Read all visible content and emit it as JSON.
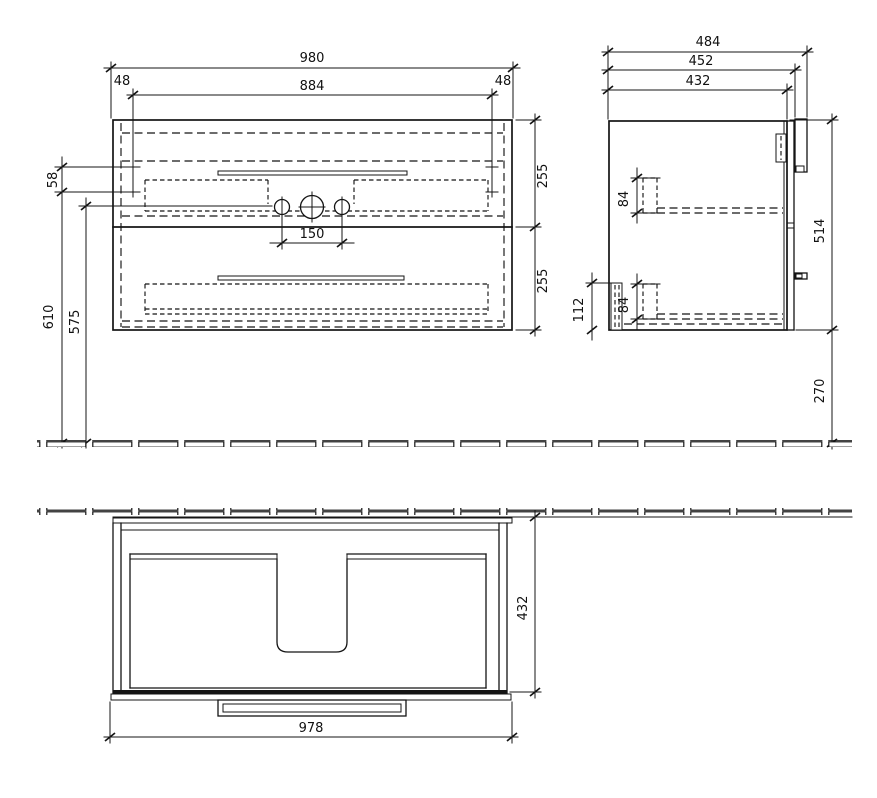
{
  "drawing": {
    "background": "#ffffff",
    "line_color": "#141414"
  },
  "dims": {
    "front": {
      "width_overall": "980",
      "width_inner": "884",
      "offset_left": "48",
      "offset_right": "48",
      "top_detail": "58",
      "height_total": "610",
      "height_holes": "575",
      "hole_spacing": "150",
      "drawer_upper": "255",
      "drawer_lower": "255"
    },
    "side": {
      "depth_overall": "484",
      "depth_front": "452",
      "depth_body": "432",
      "rail_upper": "84",
      "rail_lower": "84",
      "back_detail": "112",
      "height_body": "514",
      "floor_clearance": "270"
    },
    "plan": {
      "depth_body": "432",
      "width_front": "978"
    }
  }
}
